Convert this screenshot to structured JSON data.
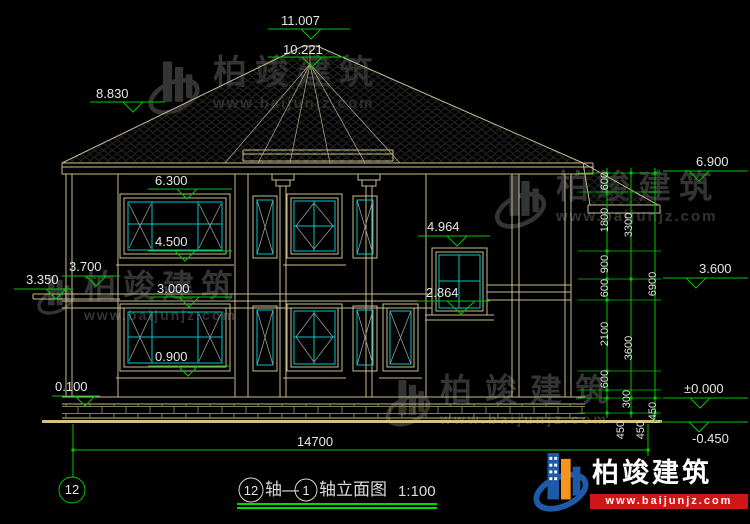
{
  "drawing": {
    "elevation_marks": {
      "ridge": "11.007",
      "turret_top": "10.221",
      "left_roof": "8.830",
      "right_eave": "6.900",
      "window_head_2f": "6.300",
      "stair_window_head": "4.964",
      "window_sill_2f": "4.500",
      "left_canopy_top": "3.700",
      "right_band_top": "3.600",
      "left_canopy_bottom": "3.350",
      "floor_2f": "3.000",
      "stair_window_sill": "2.864",
      "window_sill_1f": "0.900",
      "plinth_top_left": "0.100",
      "ground_zero": "±0.000",
      "below_grade": "-0.450"
    },
    "dim_chains": {
      "inner": [
        "600",
        "1800",
        "900",
        "600",
        "2100",
        "600",
        "300",
        "450"
      ],
      "middle": [
        "3300",
        "3600",
        "450"
      ],
      "outer": [
        "6900",
        "450"
      ],
      "total_width": "14700"
    },
    "grid_bubbles": {
      "left": "12"
    }
  },
  "title_block": {
    "start_axis": "12",
    "dash": "轴—",
    "end_axis": "1",
    "suffix": "轴立面图",
    "scale": "1:100"
  },
  "watermark": {
    "brand": "柏竣建筑",
    "url": "www.baijunjz.com"
  },
  "colors": {
    "background": "#000000",
    "wall_line": "#C8BC8E",
    "ground_line": "#D8C080",
    "dimension_green": "#00C800",
    "glass_cyan": "#00C8C8",
    "underline_green": "#00DC00",
    "logo_blue": "#1E5AA8",
    "logo_orange": "#F7941D",
    "logo_red": "#D01616",
    "watermark_gray": "#343434"
  }
}
